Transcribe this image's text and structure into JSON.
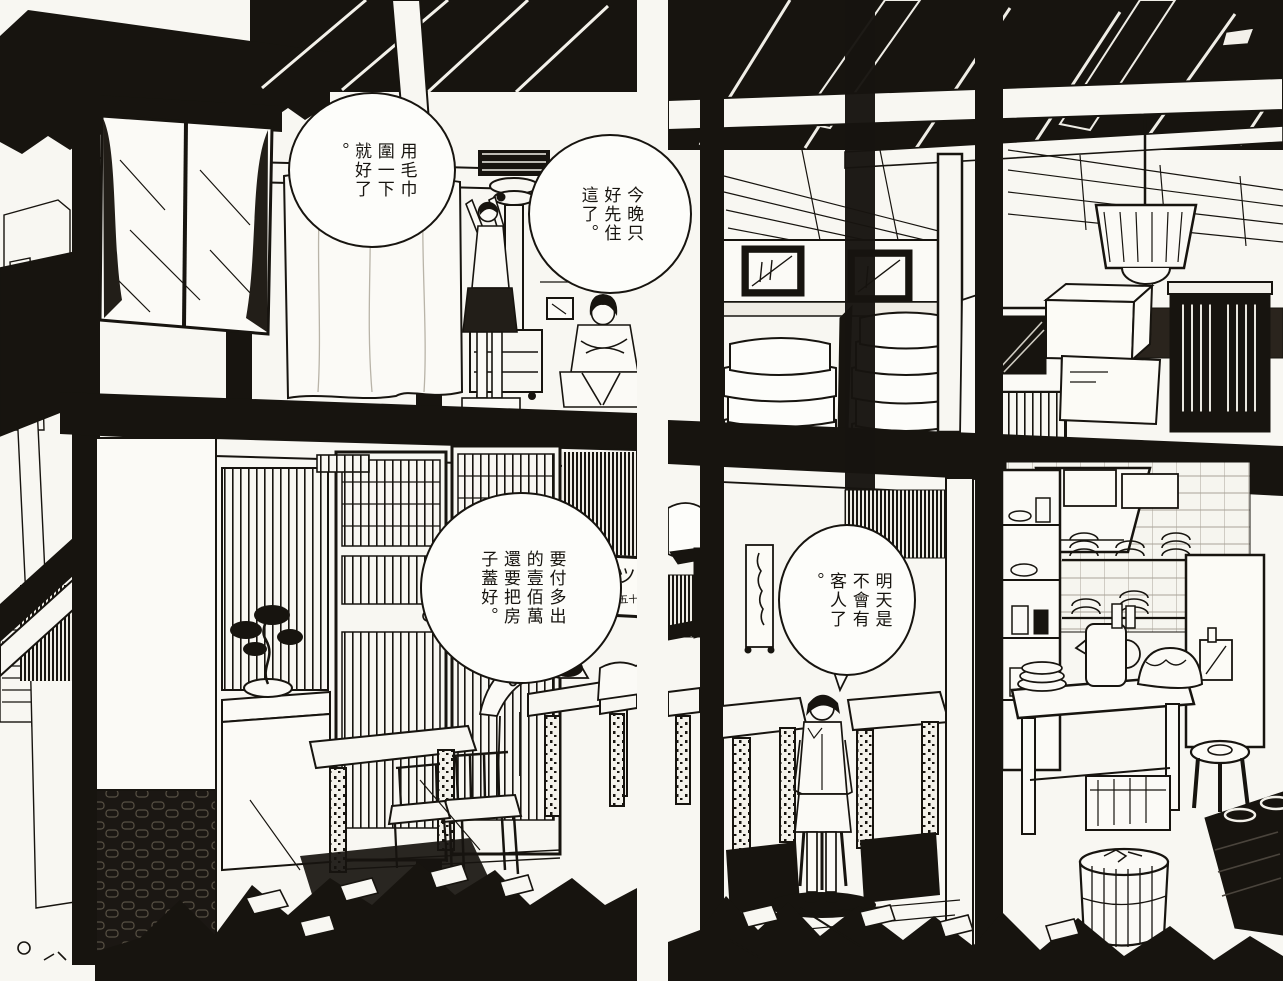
{
  "artwork": {
    "kind": "manga two-page spread, black-and-white interior cutaway of a two-storey inn-restaurant",
    "ink_color": "#17140f",
    "paper_color": "#f8f7f2"
  },
  "bubbles": {
    "towel": {
      "type": "speech",
      "text": "用毛巾\n圍一下\n就好了\n。"
    },
    "stay": {
      "type": "speech",
      "text": "今晚只\n好先住\n這了。"
    },
    "million": {
      "type": "thought",
      "text": "要付多出\n的壹佰萬\n還要把房\n子蓋好。"
    },
    "customers": {
      "type": "speech",
      "text": "明天是\n不會有\n客人了\n。"
    }
  },
  "signs": {
    "menu_sign": {
      "title": "カツ丼",
      "subtitle": "八百五十"
    }
  }
}
